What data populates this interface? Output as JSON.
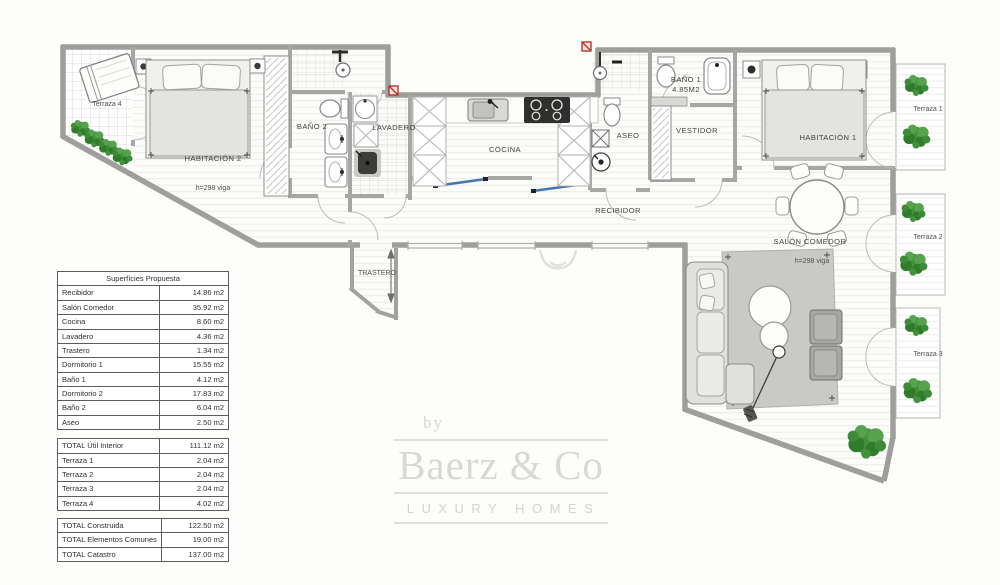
{
  "floorplan": {
    "labels": {
      "terraza4": "Terraza 4",
      "habitacion2": "HABITACIÓN 2",
      "viga2": "h=298 viga",
      "bano2": "BAÑO 2",
      "lavadero": "LAVADERO",
      "cocina": "COCINA",
      "aseo": "ASEO",
      "vestidor": "VESTIDOR",
      "bano1_line1": "BAÑO 1",
      "bano1_line2": "4.85M2",
      "habitacion1": "HABITACIÓN 1",
      "recibidor": "RECIBIDOR",
      "salon": "SALÓN COMEDOR",
      "viga1": "h=298 viga",
      "trastero": "TRASTERO",
      "terraza1": "Terraza 1",
      "terraza2": "Terraza 2",
      "terraza3": "Terraza 3"
    }
  },
  "tables": {
    "proposed": {
      "title": "Superfícies Propuesta",
      "rows": [
        [
          "Recibidor",
          "14.86 m2"
        ],
        [
          "Salón Comedor",
          "35.92 m2"
        ],
        [
          "Cocina",
          "8.60 m2"
        ],
        [
          "Lavadero",
          "4.36 m2"
        ],
        [
          "Trastero",
          "1.34 m2"
        ],
        [
          "Dormitorio 1",
          "15.55 m2"
        ],
        [
          "Baño 1",
          "4.12 m2"
        ],
        [
          "Dormitorio 2",
          "17.83 m2"
        ],
        [
          "Baño 2",
          "6.04 m2"
        ],
        [
          "Aseo",
          "2.50 m2"
        ]
      ]
    },
    "totals_util": {
      "rows": [
        [
          "TOTAL Útil Interior",
          "111.12 m2"
        ],
        [
          "Terraza 1",
          "2.04 m2"
        ],
        [
          "Terraza 2",
          "2.04 m2"
        ],
        [
          "Terraza 3",
          "2.04 m2"
        ],
        [
          "Terraza 4",
          "4.02 m2"
        ]
      ]
    },
    "totals_global": {
      "rows": [
        [
          "TOTAL Construida",
          "122.50 m2"
        ],
        [
          "TOTAL Elementos Comunes",
          "19.00 m2"
        ],
        [
          "TOTAL Catastro",
          "137.00 m2"
        ]
      ]
    }
  },
  "logo": {
    "by": "by",
    "name": "Baerz & Co",
    "tagline": "LUXURY HOMES"
  },
  "colors": {
    "wall_grey": "#9e9e9c",
    "plant_green": "#3d8b38",
    "marker_red": "#b5362a",
    "slider_blue": "#4276ad",
    "logo_grey": "#d8d8d6"
  }
}
